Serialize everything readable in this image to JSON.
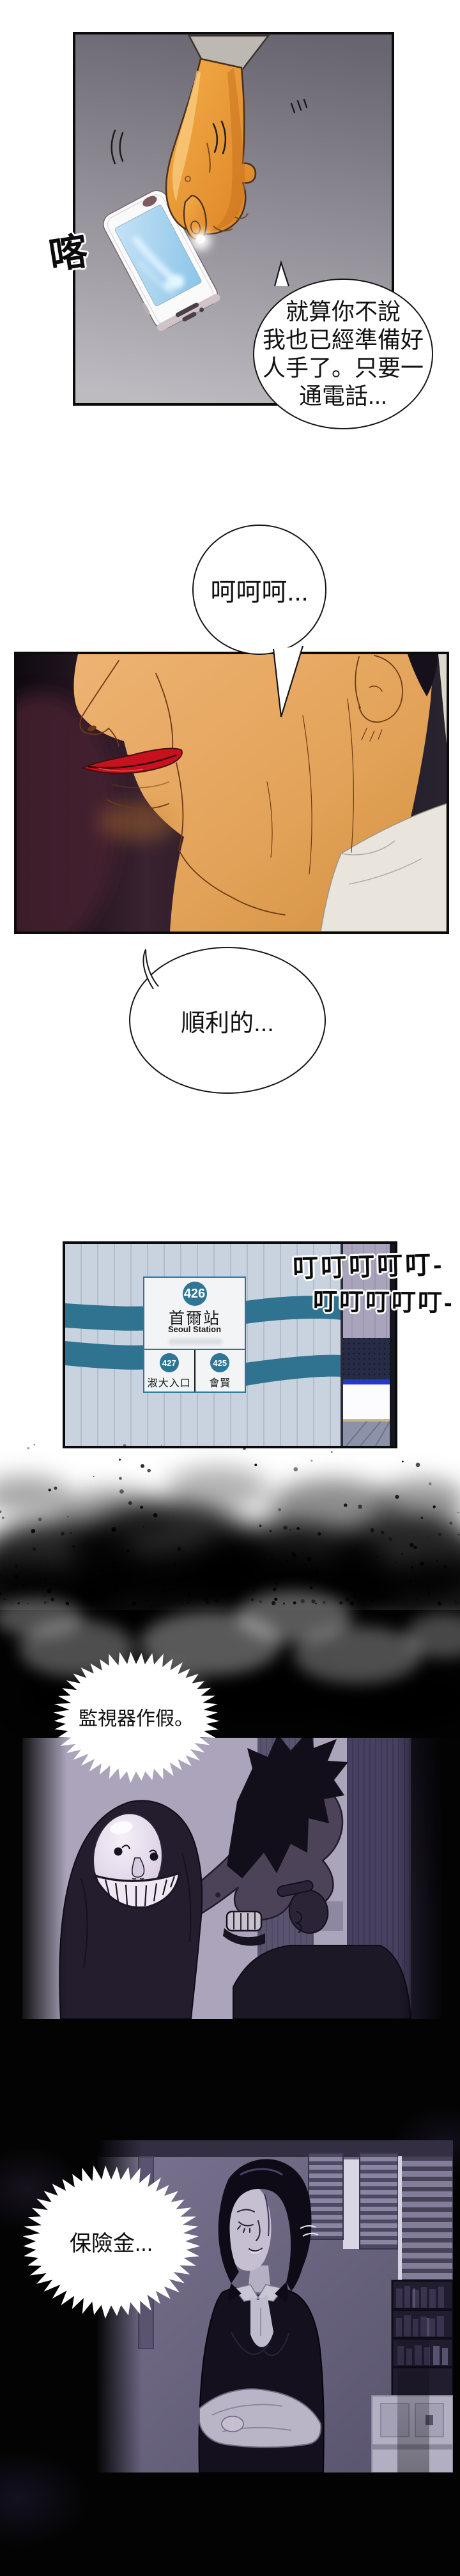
{
  "sfx": {
    "tap": "喀",
    "ring_line1": "叮叮叮叮叮-",
    "ring_line2": "叮叮叮叮叮-"
  },
  "speech": {
    "caller": {
      "line1": "就算你不說",
      "line2": "我也已經準備好",
      "line3": "人手了。只要一",
      "line4": "通電話..."
    },
    "laugh": {
      "text": "呵呵呵..."
    },
    "smooth": {
      "text": "順利的..."
    },
    "cctv": {
      "text": "監視器作假。"
    },
    "insurance": {
      "text": "保險金..."
    }
  },
  "sign": {
    "number": "426",
    "name": "首爾站",
    "name_en": "Seoul Station",
    "prev_number": "427",
    "prev_name": "淑大入口",
    "next_number": "425",
    "next_name": "會賢"
  },
  "colors": {
    "sign_teal": "#2e7596",
    "stripe_teal": "#2f7391",
    "panel_border": "#0b0b0b",
    "screen_blue": "#a9d2ee",
    "lips_red": "#c8101e",
    "hand_orange": "#ee9b3a",
    "scene_purple": "#aba4bb"
  }
}
